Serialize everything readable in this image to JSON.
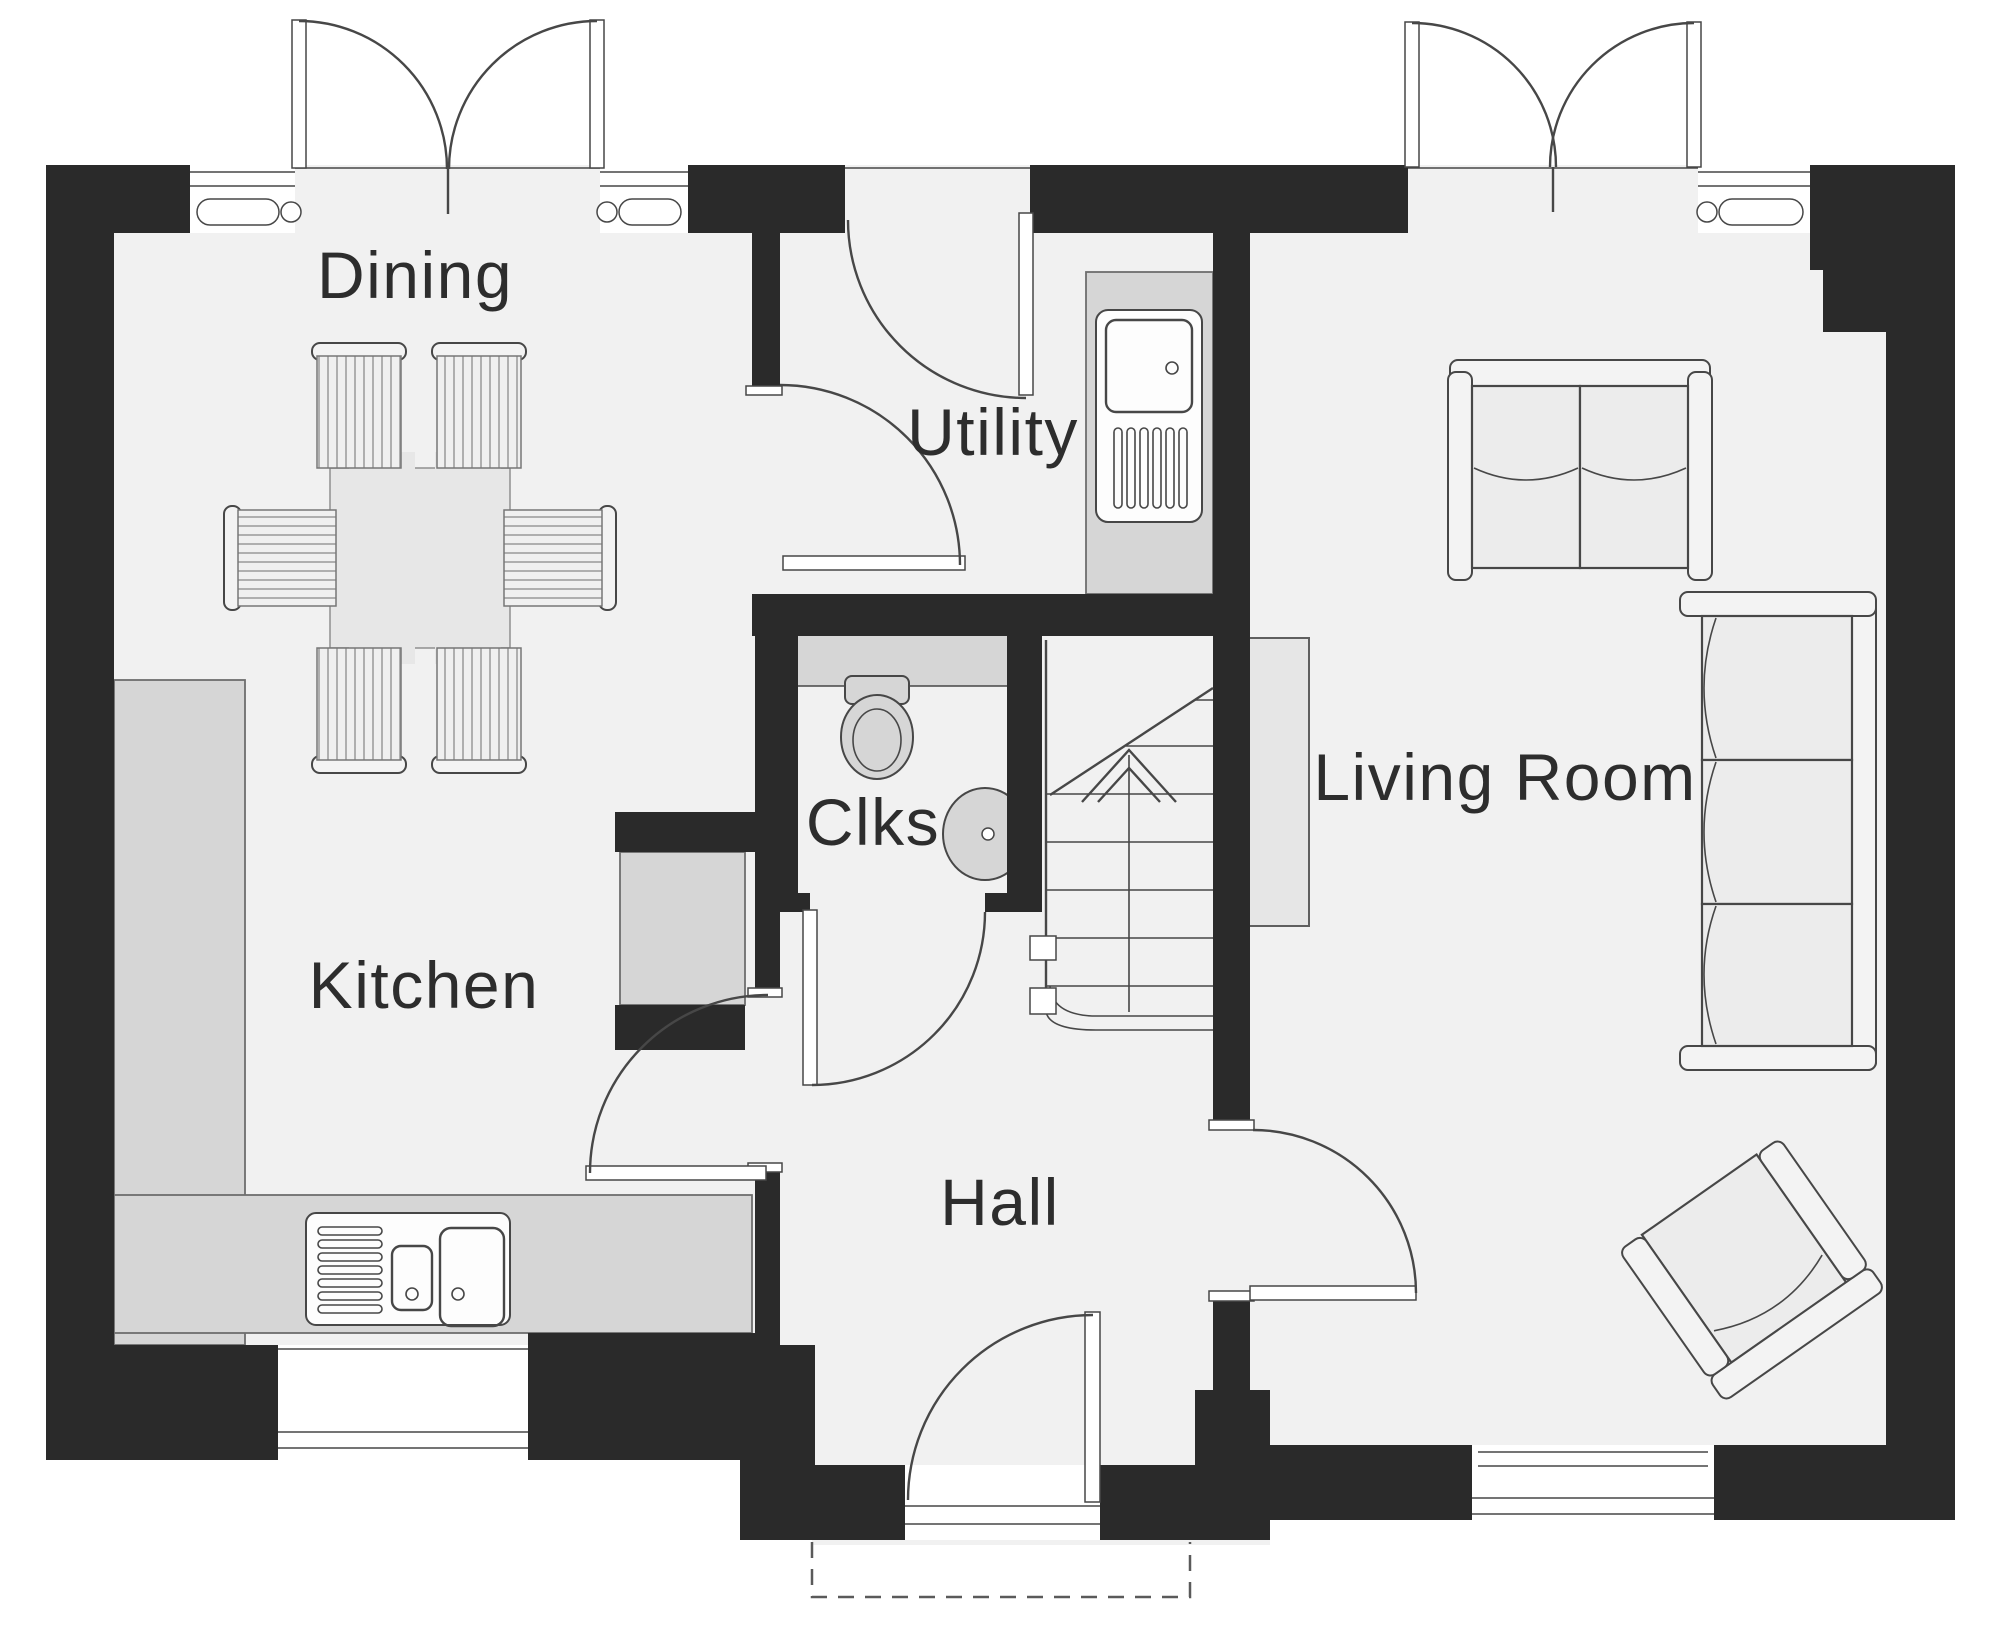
{
  "plan": {
    "image_type": "floor-plan",
    "rooms": [
      {
        "id": "dining",
        "label": "Dining"
      },
      {
        "id": "utility",
        "label": "Utility"
      },
      {
        "id": "clks",
        "label": "Clks"
      },
      {
        "id": "kitchen",
        "label": "Kitchen"
      },
      {
        "id": "hall",
        "label": "Hall"
      },
      {
        "id": "living-room",
        "label": "Living Room"
      }
    ],
    "colors": {
      "wall": "#2a2a2a",
      "floor": "#f1f1f1",
      "fixture": "#d6d6d6",
      "counter": "#d6d6d6",
      "furniture": "#ececec",
      "line": "#474747",
      "background": "#ffffff"
    }
  }
}
